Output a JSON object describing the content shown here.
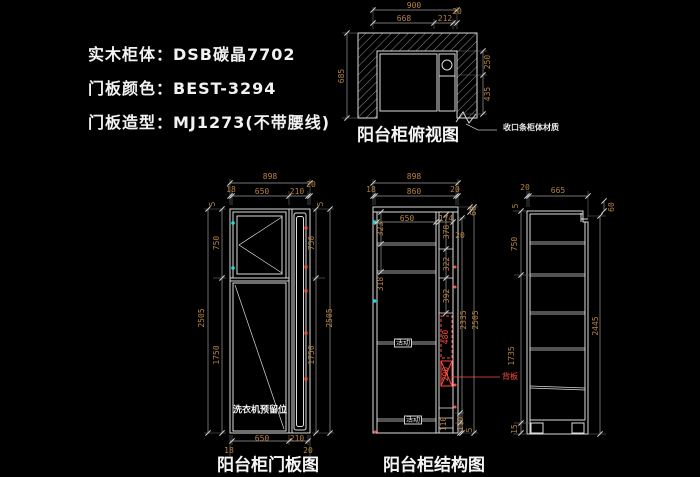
{
  "colors": {
    "background": "#000000",
    "object_line": "#dcdcdc",
    "dimension_text": "#b5823f",
    "dimension_line": "#9b9b9b",
    "highlight_red": "#ff4b3e",
    "hinge_cyan": "#19e0e0",
    "text_white": "#f2f2f2"
  },
  "spec": {
    "lines": [
      "实木柜体：DSB碳晶7702",
      "门板颜色：BEST-3294",
      "门板造型：MJ1273(不带腰线)"
    ]
  },
  "views": {
    "top": {
      "title": "阳台柜俯视图",
      "callout": "收口条柜体材质"
    },
    "door": {
      "title": "阳台柜门板图",
      "note": "洗衣机预留位"
    },
    "structure": {
      "title": "阳台柜结构图",
      "callout": "背板",
      "shelf_labels": [
        "活动",
        "活动"
      ]
    },
    "side": {}
  },
  "dim_labels": [
    {
      "t": "900",
      "x": 414,
      "y": 6
    },
    {
      "t": "668",
      "x": 404,
      "y": 19
    },
    {
      "t": "212",
      "x": 445,
      "y": 19
    },
    {
      "t": "20",
      "x": 457,
      "y": 12
    },
    {
      "t": "685",
      "x": 342,
      "y": 76,
      "r": 1
    },
    {
      "t": "250",
      "x": 488,
      "y": 62,
      "r": 1
    },
    {
      "t": "435",
      "x": 488,
      "y": 94,
      "r": 1
    },
    {
      "t": "898",
      "x": 270,
      "y": 177
    },
    {
      "t": "18",
      "x": 231,
      "y": 190
    },
    {
      "t": "650",
      "x": 262,
      "y": 192
    },
    {
      "t": "210",
      "x": 297,
      "y": 192
    },
    {
      "t": "20",
      "x": 311,
      "y": 185
    },
    {
      "t": "5",
      "x": 213,
      "y": 204,
      "r": 1
    },
    {
      "t": "750",
      "x": 217,
      "y": 243,
      "r": 1
    },
    {
      "t": "2505",
      "x": 202,
      "y": 318,
      "r": 1
    },
    {
      "t": "1750",
      "x": 217,
      "y": 355,
      "r": 1
    },
    {
      "t": "5",
      "x": 321,
      "y": 204,
      "r": 1
    },
    {
      "t": "750",
      "x": 312,
      "y": 243,
      "r": 1
    },
    {
      "t": "2505",
      "x": 330,
      "y": 318,
      "r": 1
    },
    {
      "t": "1750",
      "x": 312,
      "y": 355,
      "r": 1
    },
    {
      "t": "650",
      "x": 262,
      "y": 439
    },
    {
      "t": "210",
      "x": 297,
      "y": 439
    },
    {
      "t": "18",
      "x": 229,
      "y": 451
    },
    {
      "t": "20",
      "x": 308,
      "y": 451
    },
    {
      "t": "898",
      "x": 414,
      "y": 177
    },
    {
      "t": "18",
      "x": 371,
      "y": 190
    },
    {
      "t": "860",
      "x": 414,
      "y": 192
    },
    {
      "t": "20",
      "x": 455,
      "y": 190
    },
    {
      "t": "650",
      "x": 407,
      "y": 219
    },
    {
      "t": "174",
      "x": 446,
      "y": 219
    },
    {
      "t": "323",
      "x": 381,
      "y": 229,
      "r": 1
    },
    {
      "t": "318",
      "x": 381,
      "y": 284,
      "r": 1
    },
    {
      "t": "378",
      "x": 447,
      "y": 232,
      "r": 1
    },
    {
      "t": "20",
      "x": 460,
      "y": 236
    },
    {
      "t": "322",
      "x": 447,
      "y": 264,
      "r": 1
    },
    {
      "t": "392",
      "x": 447,
      "y": 296,
      "r": 1
    },
    {
      "t": "480",
      "x": 446,
      "y": 337,
      "r": 1,
      "c": "r"
    },
    {
      "t": "290",
      "x": 446,
      "y": 374,
      "r": 1,
      "c": "r"
    },
    {
      "t": "60",
      "x": 474,
      "y": 211,
      "r": 1
    },
    {
      "t": "2335",
      "x": 464,
      "y": 320,
      "r": 1
    },
    {
      "t": "2505",
      "x": 476,
      "y": 320,
      "r": 1
    },
    {
      "t": "110",
      "x": 444,
      "y": 424,
      "r": 1
    },
    {
      "t": "110",
      "x": 461,
      "y": 424,
      "r": 1
    },
    {
      "t": "5",
      "x": 470,
      "y": 430,
      "r": 1
    },
    {
      "t": "20",
      "x": 525,
      "y": 188
    },
    {
      "t": "665",
      "x": 558,
      "y": 191
    },
    {
      "t": "5",
      "x": 516,
      "y": 206,
      "r": 1
    },
    {
      "t": "750",
      "x": 515,
      "y": 244,
      "r": 1
    },
    {
      "t": "1735",
      "x": 512,
      "y": 356,
      "r": 1
    },
    {
      "t": "15",
      "x": 515,
      "y": 429,
      "r": 1
    },
    {
      "t": "60",
      "x": 612,
      "y": 207,
      "r": 1
    },
    {
      "t": "2445",
      "x": 596,
      "y": 326,
      "r": 1
    }
  ]
}
